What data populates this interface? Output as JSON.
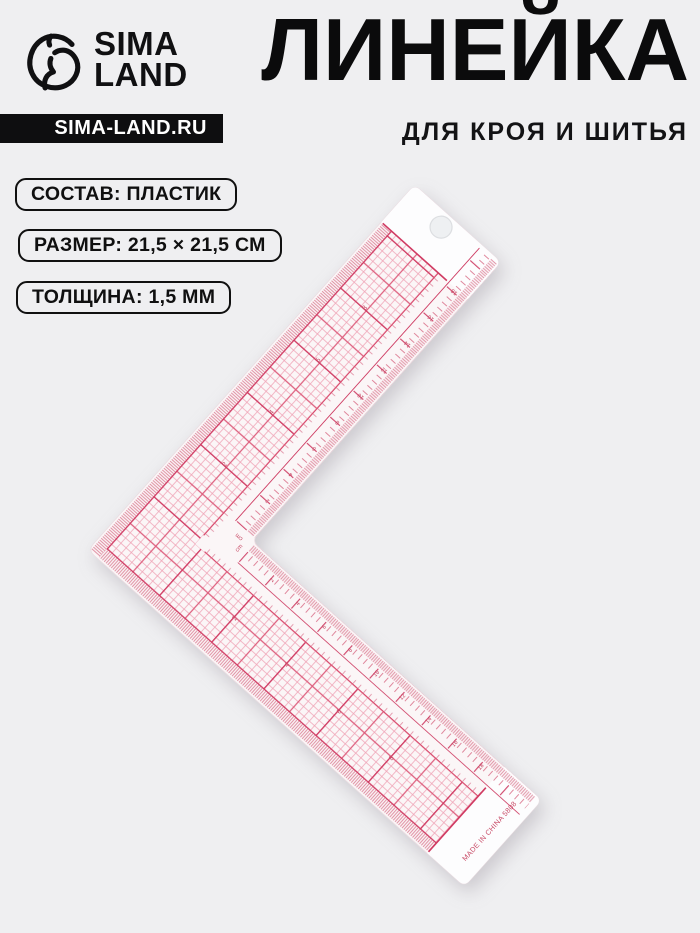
{
  "page": {
    "background": "#efeff1"
  },
  "brand": {
    "logo_line1": "SIMA",
    "logo_line2": "LAND",
    "site_badge": "SIMA-LAND.RU",
    "logo_color": "#101012"
  },
  "header": {
    "title": "ЛИНЕЙКА",
    "subtitle": "ДЛЯ КРОЯ И ШИТЬЯ"
  },
  "specs": [
    {
      "label": "СОСТАВ: ПЛАСТИК"
    },
    {
      "label": "РАЗМЕР: 21,5 × 21,5 СМ"
    },
    {
      "label": "ТОЛЩИНА: 1,5 ММ"
    }
  ],
  "ruler": {
    "made_in": "MADE IN CHINA 5808",
    "unit_label": "cm",
    "scale_numbers": [
      2,
      4,
      6,
      8,
      10,
      12,
      14,
      16,
      18
    ],
    "grid_numbers": [
      2,
      4,
      6,
      8
    ],
    "colors": {
      "grid_light": "#efa3b6",
      "grid_medium": "#dd5e7d",
      "grid_heavy": "#d03a62",
      "ink": "#c84a66",
      "body": "#fbf6f7",
      "tab": "#fdfdfe",
      "hole": "#eef0f2"
    }
  }
}
